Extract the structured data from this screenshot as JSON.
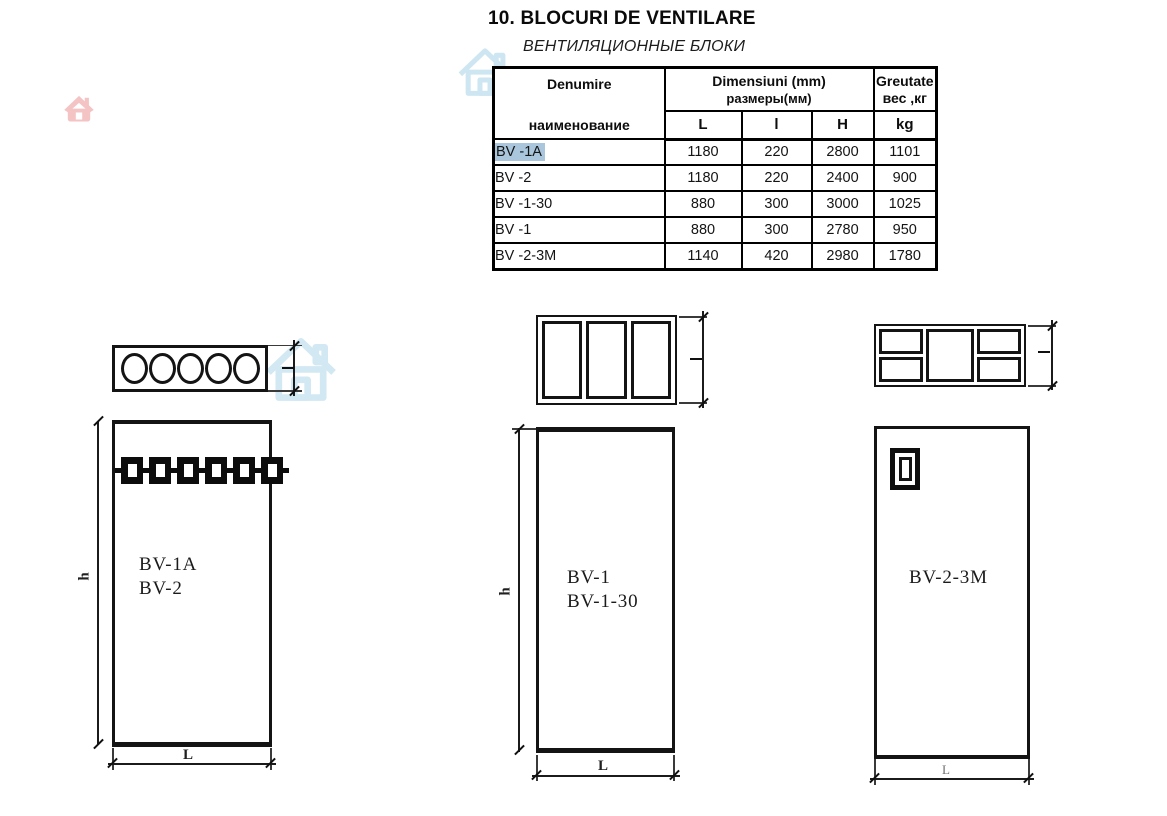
{
  "page": {
    "title": "10. BLOCURI DE VENTILARE",
    "subtitle": "ВЕНТИЛЯЦИОННЫЕ БЛОКИ"
  },
  "table": {
    "header": {
      "name_ro": "Denumire",
      "name_ru": "наименование",
      "dims_ro": "Dimensiuni  (mm)",
      "dims_ru": "размеры(мм)",
      "col_L": "L",
      "col_l": "l",
      "col_H": "H",
      "weight_ro": "Greutate",
      "weight_ru": "вес ,кг",
      "weight_unit": "kg"
    },
    "rows": [
      {
        "name": "BV -1A",
        "L": "1180",
        "l": "220",
        "H": "2800",
        "kg": "1101",
        "selected": true
      },
      {
        "name": "BV -2",
        "L": "1180",
        "l": "220",
        "H": "2400",
        "kg": "900",
        "selected": false
      },
      {
        "name": "BV -1-30",
        "L": "880",
        "l": "300",
        "H": "3000",
        "kg": "1025",
        "selected": false
      },
      {
        "name": "BV -1",
        "L": "880",
        "l": "300",
        "H": "2780",
        "kg": "950",
        "selected": false
      },
      {
        "name": "BV -2-3M",
        "L": "1140",
        "l": "420",
        "H": "2980",
        "kg": "1780",
        "selected": false
      }
    ]
  },
  "drawings": {
    "left": {
      "label_line1": "BV-1A",
      "label_line2": "BV-2",
      "dim_h": "h",
      "dim_L": "L"
    },
    "middle": {
      "label_line1": "BV-1",
      "label_line2": "BV-1-30",
      "dim_h": "h",
      "dim_L": "L"
    },
    "right": {
      "label": "BV-2-3M",
      "dim_L": "L"
    }
  },
  "icons": {
    "watermark_pink": "home-icon",
    "watermark_blue_table": "home-icon",
    "watermark_blue_drawing": "home-icon"
  },
  "colors": {
    "selection_highlight": "#a9c6dc",
    "watermark_blue": "#aed6ea",
    "watermark_pink": "#f3b9b9",
    "line": "#141414"
  }
}
